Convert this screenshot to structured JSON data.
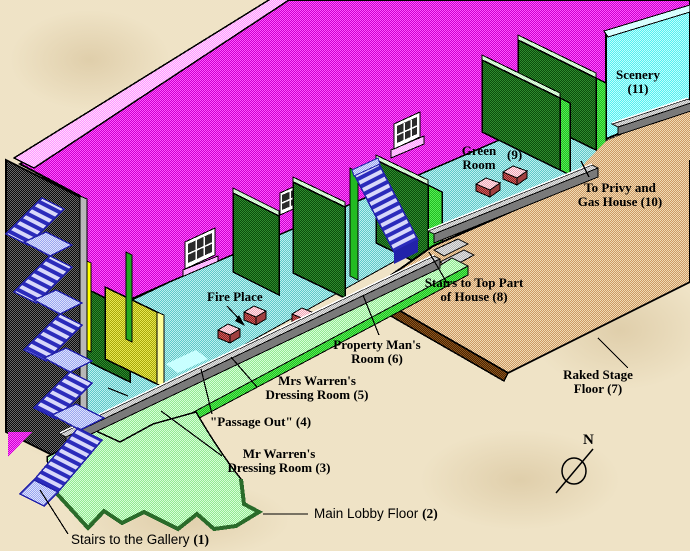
{
  "diagram": {
    "labels": {
      "scenery": {
        "line1": "Scenery",
        "line2": "(11)"
      },
      "green_room": {
        "line1": "Green",
        "line2": "Room",
        "num": "(9)"
      },
      "privy": {
        "line1": "To Privy and",
        "line2": "Gas House (10)"
      },
      "stairs_top": {
        "line1": "Stairs to Top Part",
        "line2": "of House (8)"
      },
      "raked_stage": {
        "line1": "Raked Stage",
        "line2": "Floor (7)"
      },
      "fire_place": {
        "text": "Fire Place"
      },
      "property_room": {
        "line1": "Property Man's",
        "line2": "Room (6)"
      },
      "mrs_warren": {
        "line1": "Mrs Warren's",
        "line2": "Dressing Room (5)"
      },
      "passage_out": {
        "text": "\"Passage Out\"  (4)"
      },
      "mr_warren": {
        "line1": "Mr Warren's",
        "line2": "Dressing Room (3)"
      },
      "main_lobby": {
        "text": "Main Lobby Floor ",
        "num": "(2)"
      },
      "gallery": {
        "text": "Stairs to the Gallery ",
        "num": "(1)"
      },
      "compass": {
        "letter": "N"
      }
    },
    "colors": {
      "back_wall": "#dd22dd",
      "backstage_floor": "#8cdcdc",
      "partitions": "#1e6b1e",
      "flat_edges": "#33cc33",
      "raked_stage": "#d4a878",
      "lobby_floor": "#a8f0a8",
      "stairs": "#3333cc",
      "scenery_wall": "#7ff5f5",
      "yellow_panel": "#c8c828",
      "background": "#efe3c6"
    }
  }
}
